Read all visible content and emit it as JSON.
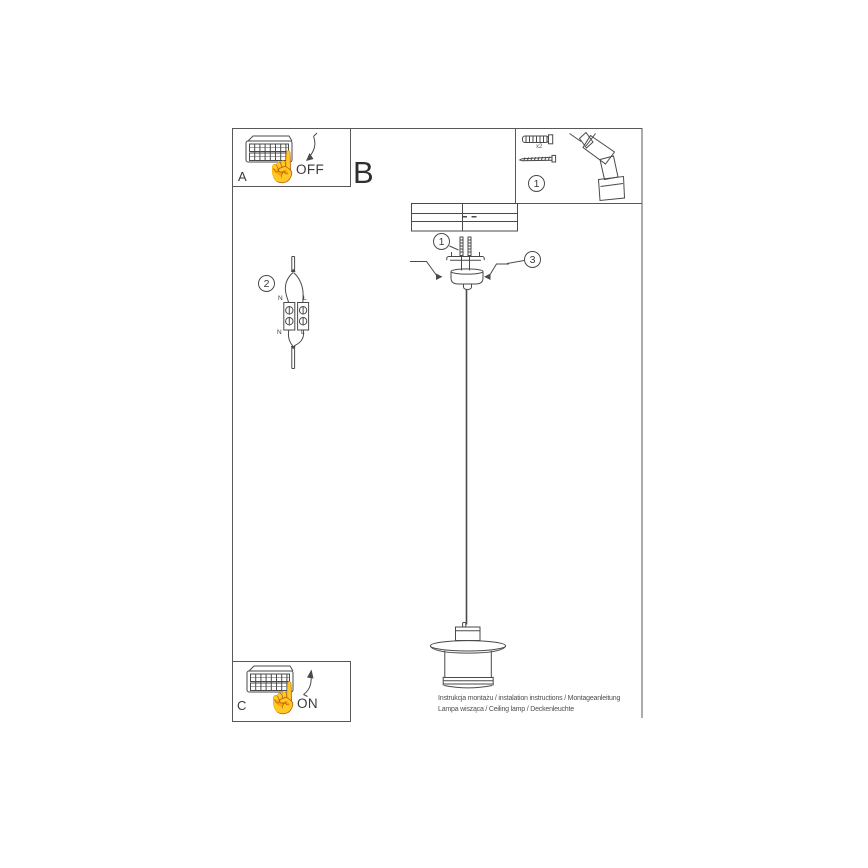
{
  "colors": {
    "line": "#4a4a4a",
    "text": "#3a3a3a",
    "muted": "#555555",
    "bg": "#ffffff"
  },
  "labels": {
    "panel_off": {
      "section": "A",
      "state": "OFF"
    },
    "panel_on": {
      "section": "C",
      "state": "ON"
    },
    "main_section": "B"
  },
  "parts": {
    "step": "1",
    "anchor_qty": "x2"
  },
  "mount": {
    "screws_step": "1",
    "bracket_step": "3"
  },
  "wiring": {
    "step": "2",
    "top": {
      "n": "N",
      "l": "L"
    },
    "bottom": {
      "n": "N",
      "l": "L"
    }
  },
  "footer": {
    "line1": "Instrukcja montażu / instalation instructions / Montageanleitung",
    "line2": "Lampa wisząca / Ceiling lamp / Deckenleuchte"
  },
  "icons": {
    "hand": "☝"
  }
}
